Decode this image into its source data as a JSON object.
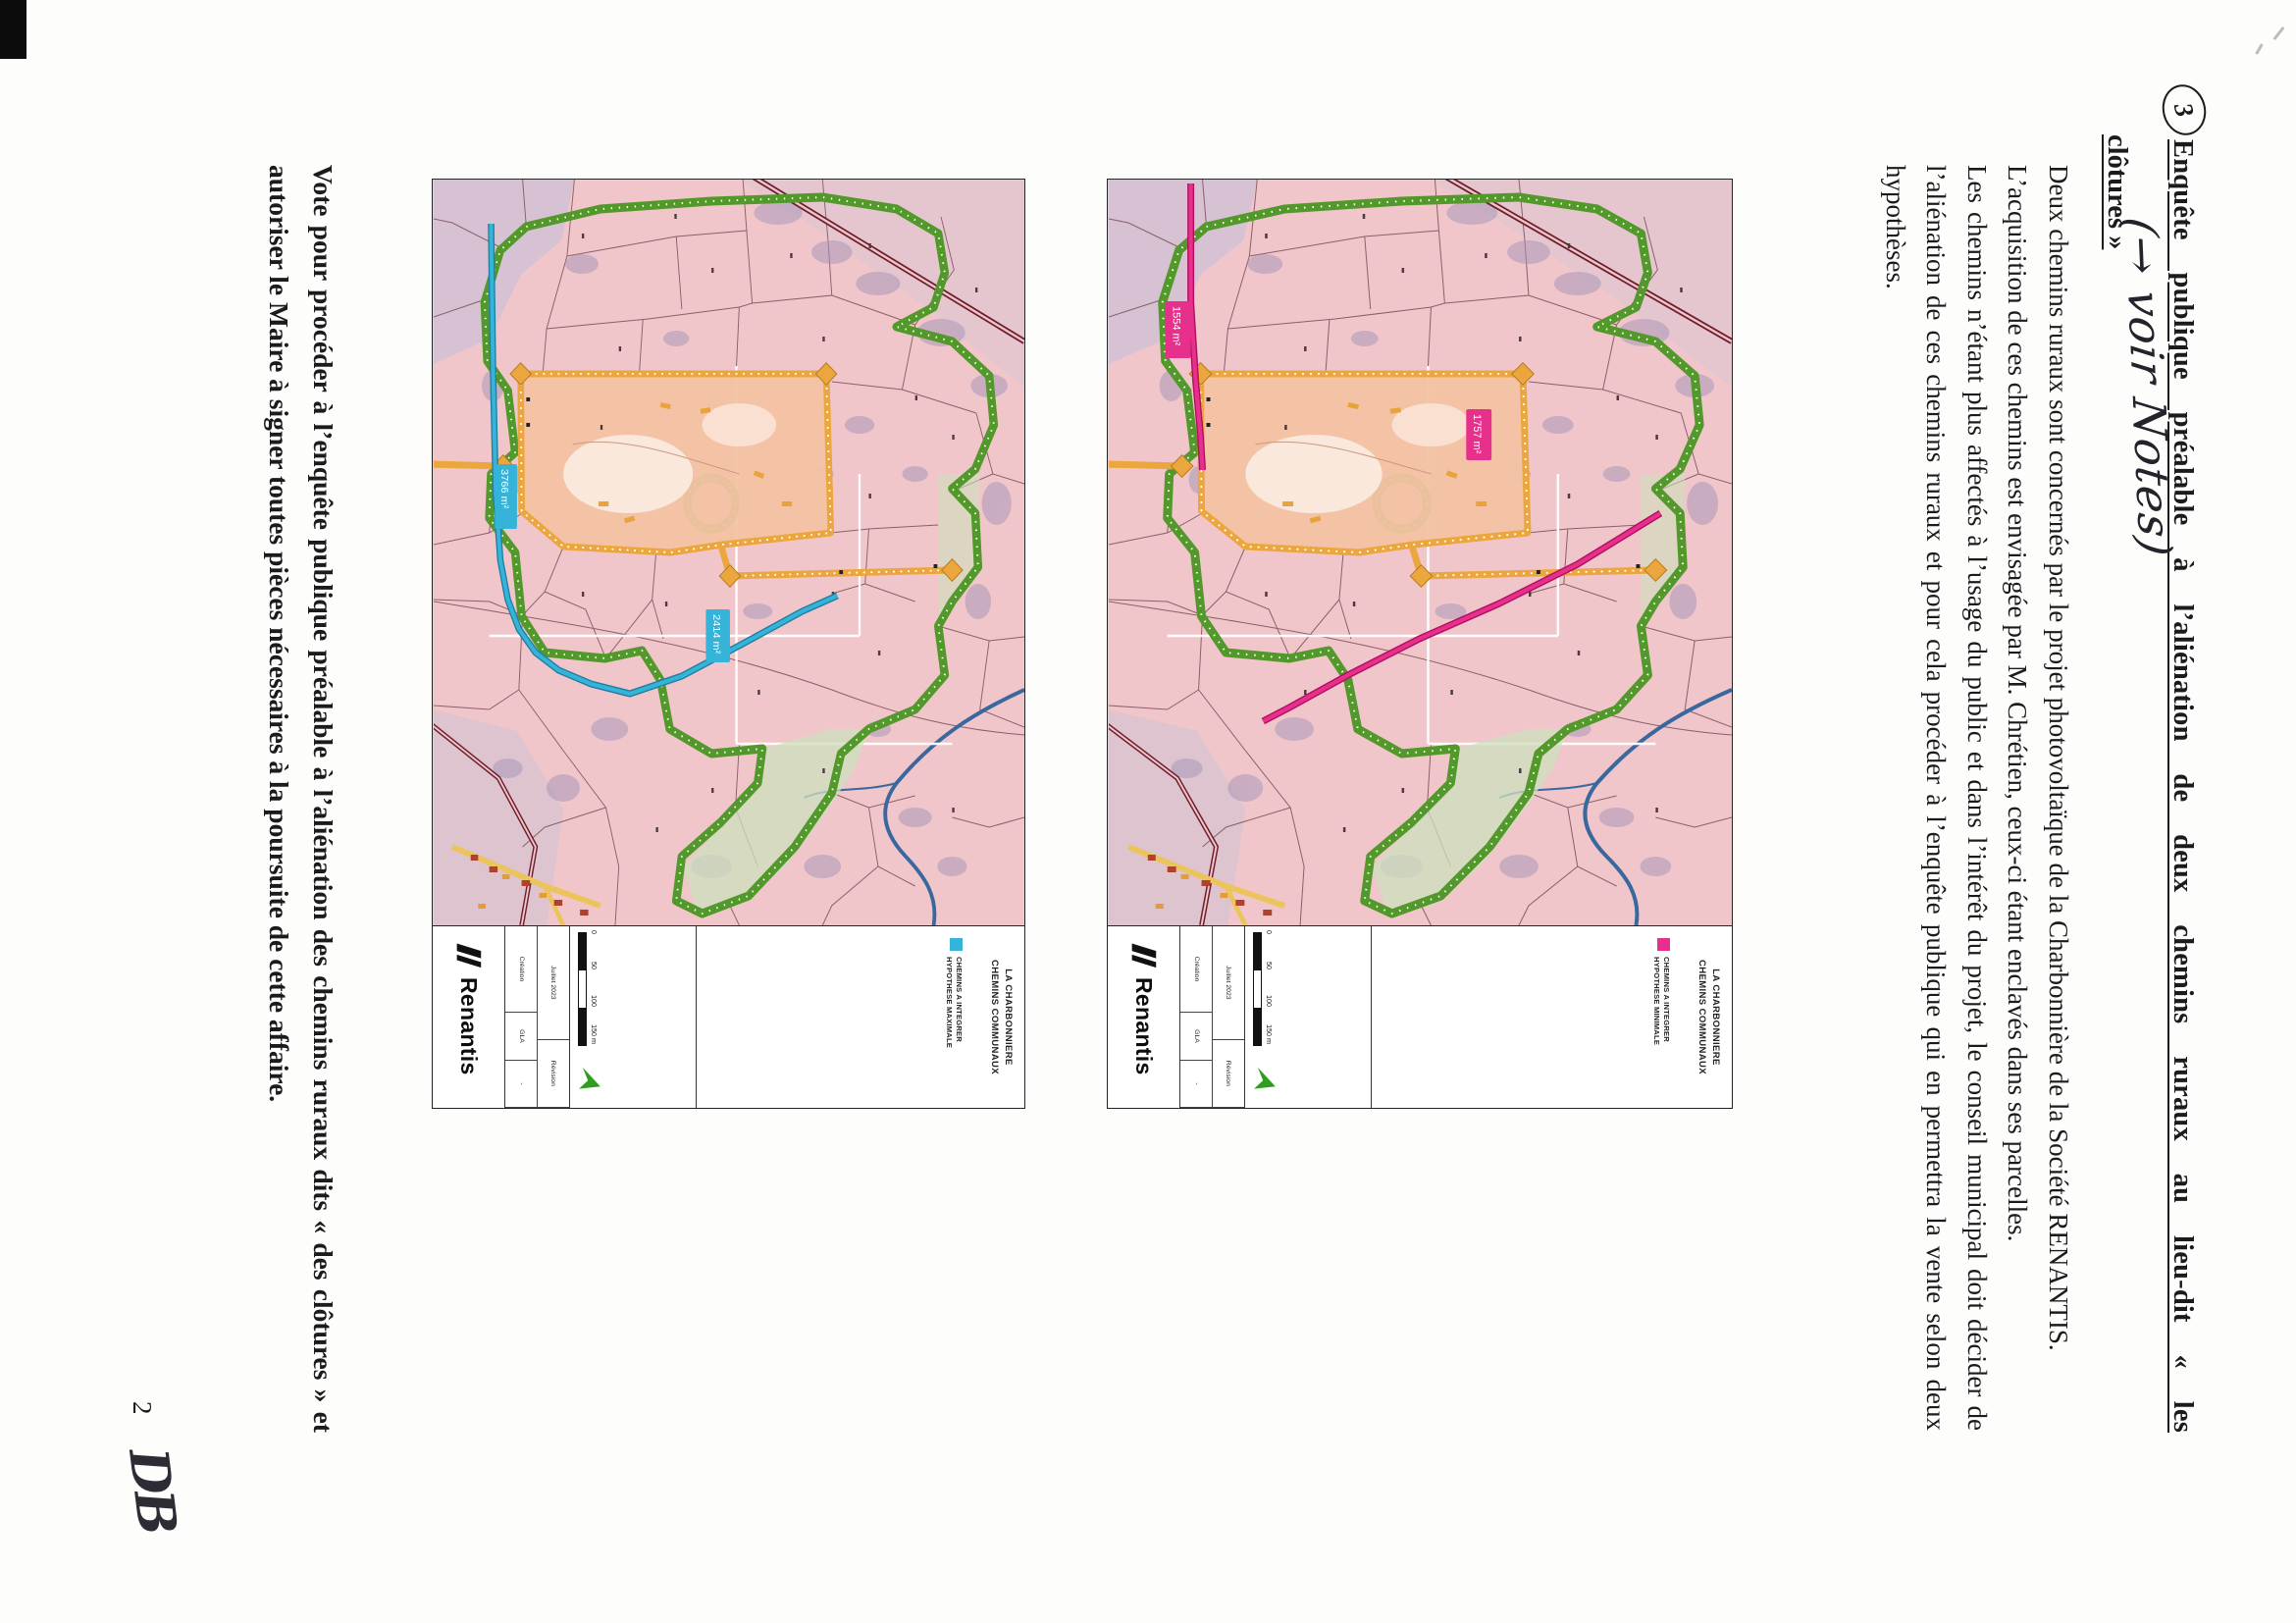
{
  "page": {
    "number": "2",
    "initials": "DB"
  },
  "heading": {
    "marker": "3",
    "title_line1": "Enquête publique préalable à l’aliénation de deux chemins ruraux au lieu-dit « les",
    "title_line2": "clôtures »",
    "annotation": "(→ voir Notes)"
  },
  "paragraphs": {
    "p1": "Deux chemins ruraux sont concernés par le projet photovoltaïque de la Charbonnière de la Société RENANTIS.",
    "p2": "L’acquisition de ces chemins est envisagée par M. Chrétien, ceux-ci étant enclavés dans ses parcelles.",
    "p3": "Les chemins n’étant plus affectés à l’usage du public et dans l’intérêt du projet, le conseil municipal doit décider de l’aliénation de ces chemins ruraux et pour cela procéder à l’enquête publique qui en permettra la vente selon deux hypothèses."
  },
  "conclusion": "Vote pour procéder à l’enquête publique préalable à l’aliénation des chemins ruraux dits « des clôtures » et autoriser le Maire à signer toutes pièces nécessaires à la poursuite de cette affaire.",
  "figures": [
    {
      "id": "hypothese-minimale",
      "route_color": "#e7308c",
      "map_title_line1": "LA CHARBONNIERE",
      "map_title_line2": "CHEMINS COMMUNAUX",
      "legend_line1": "CHEMINS A INTEGRER",
      "legend_line2": "HYPOTHESE MINIMALE",
      "logo": "Renantis",
      "scale_ticks": {
        "t0": "0",
        "t1": "50",
        "t2": "100",
        "t3": "150 m"
      },
      "table": {
        "creation_label": "Création",
        "creation_value": "Juillet 2023",
        "author": "GLA",
        "revision_label": "Révision",
        "revision_value": "-"
      },
      "labels": {
        "a": "1554 m²",
        "b": "1757 m²"
      }
    },
    {
      "id": "hypothese-maximale",
      "route_color": "#36b3d8",
      "map_title_line1": "LA CHARBONNIERE",
      "map_title_line2": "CHEMINS COMMUNAUX",
      "legend_line1": "CHEMINS A INTEGRER",
      "legend_line2": "HYPOTHESE MAXIMALE",
      "logo": "Renantis",
      "scale_ticks": {
        "t0": "0",
        "t1": "50",
        "t2": "100",
        "t3": "150 m"
      },
      "table": {
        "creation_label": "Création",
        "creation_value": "Juillet 2023",
        "author": "GLA",
        "revision_label": "Révision",
        "revision_value": "-"
      },
      "labels": {
        "a": "3766 m²",
        "b": "2414 m²"
      }
    }
  ]
}
